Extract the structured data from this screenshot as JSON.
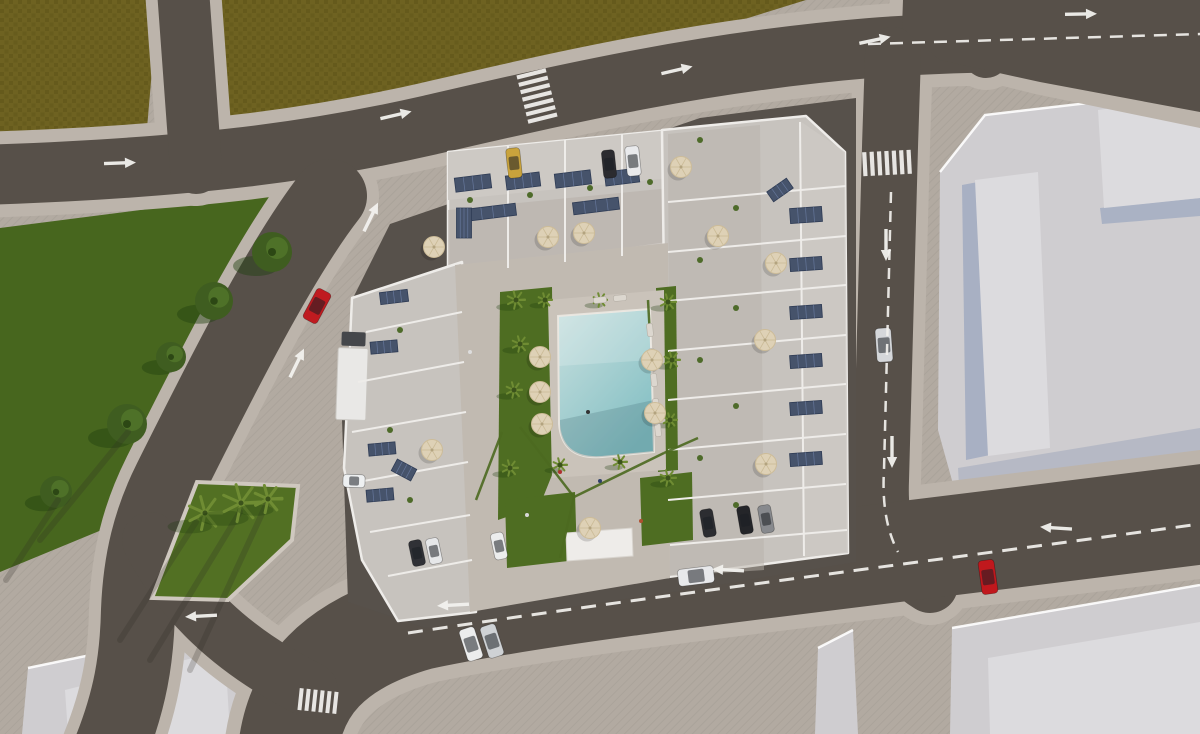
{
  "title": "aerial-3d-render-residential-complex",
  "colors": {
    "base": "#b2aaa1",
    "sidewalk": "#bcb4ab",
    "road": "#575049",
    "field": "#6e6221",
    "field_dark": "#5d5317",
    "park": "#47661e",
    "lawn": "#4e6d22",
    "island_green": "#527023",
    "roof": "#c7c3be",
    "roof_light": "#cdc9c4",
    "terrace": "#b7b1aa",
    "wall": "#eeece9",
    "plot_asphalt": "#57514b",
    "courtyard": "#c1bab1",
    "deck": "#cac3ba",
    "pool_light": "#c9e0df",
    "pool": "#83bfc3",
    "plot_light": "#cfcdd0",
    "plot_lighter": "#dcdbde",
    "shadow_blue": "#8d9cba",
    "umbrella": "#ded1b6",
    "panel": "#46536b",
    "marking": "#f2f1ee"
  },
  "scene": {
    "trees": [
      [
        272,
        252,
        20
      ],
      [
        214,
        301,
        19
      ],
      [
        171,
        357,
        15
      ],
      [
        127,
        424,
        20
      ],
      [
        56,
        492,
        16
      ]
    ],
    "island_palms": [
      [
        205,
        513,
        17
      ],
      [
        241,
        503,
        19
      ],
      [
        268,
        499,
        14
      ]
    ],
    "courtyard_palms": [
      [
        516,
        300,
        9
      ],
      [
        520,
        344,
        8
      ],
      [
        514,
        390,
        8
      ],
      [
        510,
        468,
        8
      ],
      [
        545,
        300,
        7
      ],
      [
        668,
        302,
        8
      ],
      [
        672,
        360,
        8
      ],
      [
        670,
        420,
        7
      ],
      [
        668,
        478,
        8
      ],
      [
        600,
        300,
        7
      ],
      [
        560,
        465,
        7
      ],
      [
        620,
        462,
        7
      ]
    ],
    "plants": [
      [
        700,
        140
      ],
      [
        736,
        208
      ],
      [
        700,
        260
      ],
      [
        736,
        308
      ],
      [
        700,
        360
      ],
      [
        736,
        406
      ],
      [
        700,
        458
      ],
      [
        736,
        505
      ],
      [
        470,
        200
      ],
      [
        530,
        195
      ],
      [
        590,
        188
      ],
      [
        650,
        182
      ],
      [
        400,
        330
      ],
      [
        390,
        430
      ],
      [
        410,
        500
      ],
      [
        430,
        545
      ]
    ],
    "umbrellas": [
      [
        548,
        237
      ],
      [
        584,
        233
      ],
      [
        434,
        247
      ],
      [
        718,
        236
      ],
      [
        681,
        167
      ],
      [
        776,
        263
      ],
      [
        765,
        340
      ],
      [
        766,
        464
      ],
      [
        540,
        357
      ],
      [
        540,
        392
      ],
      [
        542,
        424
      ],
      [
        652,
        360
      ],
      [
        655,
        413
      ],
      [
        590,
        528
      ],
      [
        432,
        450
      ]
    ],
    "panels": [
      [
        473,
        183,
        36,
        14,
        -7
      ],
      [
        523,
        181,
        34,
        14,
        -7
      ],
      [
        573,
        179,
        36,
        14,
        -7
      ],
      [
        622,
        177,
        34,
        14,
        -7
      ],
      [
        493,
        212,
        46,
        12,
        -7
      ],
      [
        596,
        206,
        46,
        12,
        -7
      ],
      [
        394,
        297,
        28,
        12,
        -7
      ],
      [
        464,
        223,
        15,
        30,
        0
      ],
      [
        780,
        190,
        24,
        12,
        -35
      ],
      [
        806,
        215,
        32,
        15,
        -4
      ],
      [
        806,
        264,
        32,
        13,
        -4
      ],
      [
        806,
        312,
        32,
        13,
        -4
      ],
      [
        806,
        361,
        32,
        13,
        -4
      ],
      [
        806,
        408,
        32,
        13,
        -4
      ],
      [
        806,
        459,
        32,
        13,
        -4
      ],
      [
        384,
        347,
        27,
        12,
        -5
      ],
      [
        382,
        449,
        27,
        12,
        -5
      ],
      [
        404,
        470,
        22,
        13,
        28
      ],
      [
        380,
        495,
        27,
        12,
        -5
      ]
    ],
    "cars": [
      [
        514,
        163,
        84,
        30,
        14,
        "#c9a33c"
      ],
      [
        609,
        164,
        84,
        28,
        13,
        "#2b2b2f"
      ],
      [
        633,
        161,
        84,
        30,
        14,
        "#e9eaec"
      ],
      [
        317,
        306,
        -62,
        34,
        16,
        "#bf1b20"
      ],
      [
        884,
        345,
        86,
        34,
        16,
        "#d5d7da"
      ],
      [
        988,
        577,
        82,
        34,
        16,
        "#c0181d"
      ],
      [
        696,
        576,
        -7,
        36,
        17,
        "#e8e9eb"
      ],
      [
        471,
        644,
        72,
        33,
        16,
        "#eceded"
      ],
      [
        492,
        641,
        72,
        33,
        16,
        "#cfd2d5"
      ],
      [
        417,
        553,
        78,
        26,
        13,
        "#303136"
      ],
      [
        434,
        551,
        78,
        26,
        13,
        "#e6e7e9"
      ],
      [
        499,
        546,
        78,
        27,
        13,
        "#eceded"
      ],
      [
        708,
        523,
        80,
        28,
        13,
        "#2c2d31"
      ],
      [
        745,
        520,
        80,
        28,
        13,
        "#242529"
      ],
      [
        766,
        519,
        80,
        28,
        13,
        "#87898d"
      ],
      [
        354,
        481,
        2,
        22,
        13,
        "#eef0f1"
      ]
    ],
    "loungers": [
      [
        650,
        330,
        84
      ],
      [
        652,
        355,
        84
      ],
      [
        654,
        380,
        84
      ],
      [
        656,
        405,
        84
      ],
      [
        658,
        430,
        84
      ],
      [
        600,
        300,
        -6
      ],
      [
        620,
        298,
        -6
      ]
    ],
    "walls": [
      [
        508,
        146,
        508,
        268
      ],
      [
        565,
        140,
        565,
        262
      ],
      [
        622,
        134,
        622,
        256
      ],
      [
        668,
        202,
        846,
        186
      ],
      [
        668,
        252,
        846,
        236
      ],
      [
        668,
        301,
        846,
        285
      ],
      [
        668,
        351,
        846,
        335
      ],
      [
        668,
        400,
        846,
        384
      ],
      [
        668,
        450,
        846,
        434
      ],
      [
        668,
        500,
        846,
        484
      ],
      [
        670,
        545,
        847,
        530
      ],
      [
        800,
        122,
        804,
        556
      ],
      [
        366,
        332,
        462,
        312
      ],
      [
        358,
        382,
        464,
        362
      ],
      [
        352,
        432,
        466,
        412
      ],
      [
        358,
        482,
        468,
        462
      ],
      [
        370,
        532,
        470,
        515
      ],
      [
        388,
        576,
        472,
        560
      ]
    ],
    "hedges": [
      [
        520,
        427,
        574,
        497
      ],
      [
        574,
        497,
        664,
        453
      ],
      [
        574,
        497,
        560,
        558
      ],
      [
        502,
        432,
        476,
        500
      ],
      [
        664,
        453,
        698,
        438
      ],
      [
        648,
        300,
        650,
        336
      ]
    ],
    "people": [
      [
        560,
        472,
        "#b03030"
      ],
      [
        600,
        481,
        "#30406a"
      ],
      [
        527,
        515,
        "#d8d8d8"
      ],
      [
        588,
        412,
        "#333333"
      ],
      [
        641,
        521,
        "#b05030"
      ],
      [
        470,
        352,
        "#dddddd"
      ]
    ],
    "shadow_streaks": [
      [
        196,
        522,
        120,
        640
      ],
      [
        240,
        512,
        150,
        660
      ],
      [
        266,
        505,
        190,
        670
      ],
      [
        58,
        500,
        6,
        580
      ],
      [
        128,
        432,
        40,
        540
      ]
    ],
    "markings": {
      "arrows": [
        [
          120,
          163,
          -2
        ],
        [
          396,
          115,
          -13
        ],
        [
          677,
          70,
          -13
        ],
        [
          1081,
          14,
          -1
        ],
        [
          875,
          40,
          -12
        ],
        [
          886,
          245,
          90
        ],
        [
          892,
          452,
          90
        ],
        [
          297,
          363,
          -64
        ],
        [
          371,
          217,
          -64
        ],
        [
          453,
          605,
          177
        ],
        [
          728,
          570,
          183
        ],
        [
          1056,
          528,
          184
        ],
        [
          201,
          616,
          177
        ]
      ],
      "dashes": [
        {
          "d": "M868,44 L1200,34",
          "w": 2.5,
          "dash": "13 9"
        },
        {
          "d": "M891,192 L884,470 Q881,520 898,552",
          "w": 2.5,
          "dash": "11 8"
        },
        {
          "d": "M408,633 C640,598 900,565 1200,524",
          "w": 3,
          "dash": "15 10"
        }
      ],
      "crosswalks": [
        {
          "x": 537,
          "y": 96,
          "rot": -14,
          "n": 7,
          "mode": "h",
          "bw": 30,
          "bh": 4.2,
          "step": 7.6
        },
        {
          "x": 887,
          "y": 163,
          "rot": -3,
          "n": 7,
          "mode": "v",
          "bw": 4.2,
          "bh": 24,
          "step": 7.4
        },
        {
          "x": 318,
          "y": 701,
          "rot": 6,
          "n": 6,
          "mode": "v",
          "bw": 4,
          "bh": 22,
          "step": 7
        }
      ]
    }
  }
}
